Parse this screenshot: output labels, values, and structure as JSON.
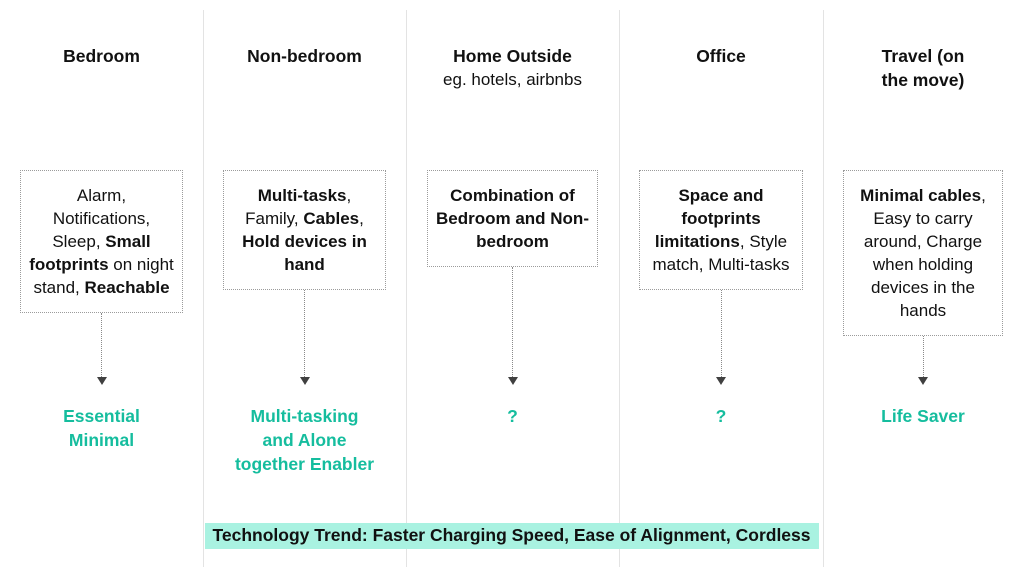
{
  "theme": {
    "accent": "#15bd9e",
    "highlight": "#a9f2e1",
    "divider": "#e3e3e3",
    "box_border": "#9b9b9b",
    "arrow": "#8a8a8a",
    "arrowhead": "#404040",
    "text": "#111111"
  },
  "icons": {
    "down_arrow": "dotted-down-arrow"
  },
  "columns": [
    {
      "id": "bedroom",
      "title": "Bedroom",
      "subtitle": "",
      "box_segments": [
        {
          "t": "Alarm, Notifications, Sleep, "
        },
        {
          "t": "Small footprints",
          "b": true
        },
        {
          "t": " on night stand, "
        },
        {
          "t": "Reachable",
          "b": true
        }
      ],
      "label": "Essential\nMinimal"
    },
    {
      "id": "non-bedroom",
      "title": "Non-bedroom",
      "subtitle": "",
      "box_segments": [
        {
          "t": "Multi-tasks",
          "b": true
        },
        {
          "t": ", Family, "
        },
        {
          "t": "Cables",
          "b": true
        },
        {
          "t": ", "
        },
        {
          "t": "Hold devices in hand",
          "b": true
        }
      ],
      "label": "Multi-tasking\nand Alone\ntogether Enabler"
    },
    {
      "id": "home-outside",
      "title": "Home Outside",
      "subtitle": "eg. hotels, airbnbs",
      "box_segments": [
        {
          "t": "Combination of Bedroom and Non-bedroom",
          "b": true
        }
      ],
      "label": "?"
    },
    {
      "id": "office",
      "title": "Office",
      "subtitle": "",
      "box_segments": [
        {
          "t": "Space and footprints limitations",
          "b": true
        },
        {
          "t": ", Style match, Multi-tasks"
        }
      ],
      "label": "?"
    },
    {
      "id": "travel",
      "title": "Travel (on\nthe move)",
      "subtitle": "",
      "box_segments": [
        {
          "t": "Minimal cables",
          "b": true
        },
        {
          "t": ", Easy to carry around, Charge when holding devices in the hands"
        }
      ],
      "label": "Life Saver"
    }
  ],
  "trend_banner": {
    "text": "Technology Trend: Faster Charging Speed, Ease of Alignment, Cordless"
  }
}
